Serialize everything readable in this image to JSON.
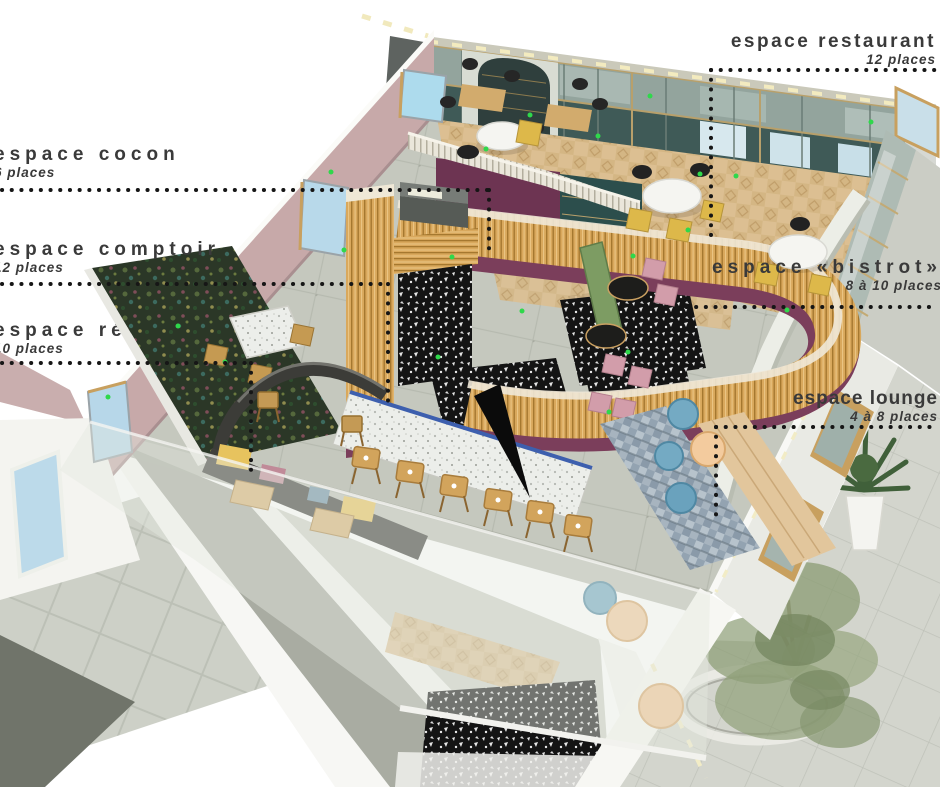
{
  "annotations": {
    "restaurant": {
      "title": "espace restaurant",
      "places": "12 places"
    },
    "cocon": {
      "title": "espace cocon",
      "places": "6 places"
    },
    "comptoir": {
      "title": "espace comptoir",
      "places": "12 places"
    },
    "refectoire": {
      "title": "espace réfectoire",
      "places": "10 places"
    },
    "bistrot": {
      "title": "espace «bistrot»",
      "places": "8 à 10 places"
    },
    "lounge": {
      "title": "espace lounge",
      "places": "4 à 8 places"
    }
  },
  "palette": {
    "wood_slats": "#d9a85c",
    "plum_base": "#7b3e5b",
    "teal_wall": "#3f5a57",
    "pink_wall": "#c7a9a9",
    "parquet": "#dcbf92",
    "terrazzo_black": "#141414",
    "floor_gray": "#c5c8be",
    "wallpaper_green": "#2b3727",
    "chair_yellow": "#ddb84a",
    "chair_pink": "#d29daa",
    "bench_green": "#7d9c63",
    "pouf_blue": "#74aac3",
    "pouf_peach": "#f3cb9e",
    "table_edge_blue": "#3d5fae",
    "accent_green_dot": "#2fd84b"
  }
}
